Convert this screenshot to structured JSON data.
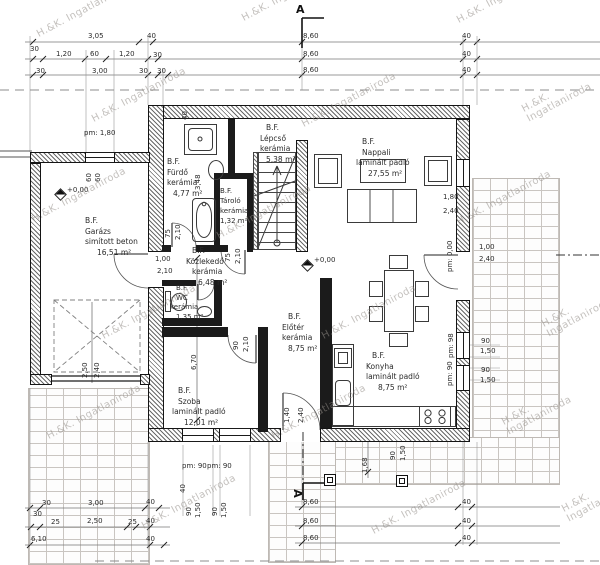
{
  "watermark": "H.&K. Ingatlaniroda",
  "section_marker": "A",
  "levels": {
    "garage": "+0,00",
    "living": "+0,00"
  },
  "rooms": {
    "garazs": {
      "floor": "B.F.",
      "name": "Garázs",
      "finish": "simított beton",
      "area": "16,51 m²"
    },
    "furdo": {
      "floor": "B.F.",
      "name": "Fürdő",
      "finish": "kerámia",
      "area": "4,77 m²"
    },
    "lepcso": {
      "floor": "B.F.",
      "name": "Lépcső",
      "finish": "kerámia",
      "area": "5,38 m²"
    },
    "tarolo": {
      "floor": "B.F.",
      "name": "Tároló",
      "finish": "kerámia",
      "area": "1,32 m²"
    },
    "kozlekedo": {
      "floor": "B.F.",
      "name": "Közlekedő",
      "finish": "kerámia",
      "area": "6,48 m²"
    },
    "wc": {
      "floor": "B.F.",
      "name": "WC",
      "finish": "kerámia",
      "area": "1,35 m²"
    },
    "nappali": {
      "floor": "B.F.",
      "name": "Nappali",
      "finish": "laminált padló",
      "area": "27,55 m²"
    },
    "eloter": {
      "floor": "B.F.",
      "name": "Előtér",
      "finish": "kerámia",
      "area": "8,75 m²"
    },
    "szoba": {
      "floor": "B.F.",
      "name": "Szoba",
      "finish": "laminált padló",
      "area": "12,01 m²"
    },
    "konyha": {
      "floor": "B.F.",
      "name": "Konyha",
      "finish": "laminált padló",
      "area": "8,75 m²"
    }
  },
  "dims": {
    "top1": [
      "3,05",
      "40",
      "8,60",
      "40"
    ],
    "top2": [
      "30",
      "1,20",
      "60",
      "1,20",
      "30",
      "8,60",
      "40"
    ],
    "top3": [
      "30",
      "3,00",
      "30",
      "30",
      "8,60",
      "40"
    ],
    "bl1": [
      "30",
      "3,00",
      "40"
    ],
    "bl2": [
      "30"
    ],
    "bl3": [
      "25",
      "2,50",
      "25",
      "40"
    ],
    "bl4": [
      "6,10",
      "40"
    ],
    "br": [
      "8,60",
      "40",
      "8,60",
      "40",
      "8,60",
      "40"
    ],
    "garage_window_parapet": "pm: 1,80",
    "garage_window_halves": [
      "60",
      "60"
    ],
    "garage_door": [
      "2,50",
      "2,40"
    ],
    "garage_entry_door": [
      "1,00",
      "2,10"
    ],
    "bath_door": [
      "75",
      "2,10"
    ],
    "bath_width": "3,48",
    "wall_thickness": "40",
    "storage_door": [
      "75",
      "2,10"
    ],
    "room_door": [
      "90",
      "2,10"
    ],
    "room_length": "6,70",
    "front_door": [
      "1,40",
      "2,40"
    ],
    "room_window_parapets": [
      "pm: 90",
      "pm: 90"
    ],
    "room_wall": "40",
    "room_windows": [
      "90",
      "1,50",
      "90",
      "1,50"
    ],
    "walkway": [
      "1,68",
      "90",
      "1,50"
    ],
    "living_window": [
      "1,80",
      "2,40"
    ],
    "terrace_door_parapet": "pm: 0,00",
    "terrace_door": [
      "1,00",
      "2,40"
    ],
    "kitchen_window1_parapet": "pm: 98",
    "kitchen_window1": [
      "90",
      "1,50"
    ],
    "kitchen_window2_parapet": "pm: 90",
    "kitchen_window2": [
      "90",
      "1,50"
    ]
  }
}
